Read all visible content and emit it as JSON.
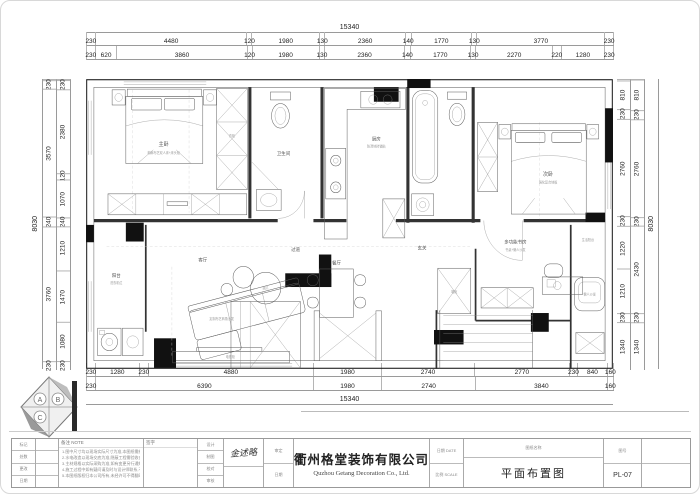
{
  "dims": {
    "top": {
      "total": "15340",
      "row1": [
        230,
        4480,
        120,
        1980,
        130,
        2360,
        140,
        1770,
        130,
        3770,
        230
      ],
      "row2": [
        230,
        620,
        3860,
        120,
        1980,
        130,
        2360,
        140,
        1770,
        130,
        2270,
        220,
        1280,
        230
      ]
    },
    "bottom": {
      "row1": [
        230,
        1280,
        230,
        4880,
        1980,
        2740,
        2770,
        230,
        840,
        160
      ],
      "row2": [
        230,
        6390,
        1980,
        2740,
        3840,
        160
      ],
      "total": "15340"
    },
    "left": {
      "total": "8030",
      "outer": [
        230,
        3570,
        240,
        3760,
        230
      ],
      "inner": [
        230,
        2380,
        120,
        1070,
        240,
        1210,
        1470,
        1080,
        230
      ]
    },
    "right": {
      "inner": [
        810,
        230,
        2760,
        230,
        1220,
        1210,
        230,
        1340
      ],
      "outer": [
        810,
        230,
        2760,
        230,
        2430,
        230,
        1340
      ],
      "total": "8030"
    }
  },
  "rooms": {
    "master": {
      "name": "主卧",
      "note": "棉麻布艺双人床+床头柜",
      "wardrobe": "衣柜"
    },
    "bath1": {
      "name": "卫生间"
    },
    "kitchen": {
      "name": "厨房",
      "note": "防滑地砖铺贴"
    },
    "bed2": {
      "name": "次卧",
      "note": "强化复合地板"
    },
    "hallway": {
      "name": "过道"
    },
    "balcony": {
      "name": "阳台",
      "note": "洗衣机位"
    },
    "living": {
      "name": "客厅",
      "table_note": "圆几",
      "sofa_note": "定制布艺转角沙发",
      "tv_note": "电视柜"
    },
    "dining": {
      "name": "餐厅"
    },
    "entry": {
      "name": "玄关",
      "cabinet_note": "鞋柜"
    },
    "study": {
      "name": "多功能书房",
      "note": "书桌+懒人沙发"
    },
    "balcony2": {
      "name": "生活阳台",
      "chair_note": "懒人沙发"
    }
  },
  "compass": {
    "letters": [
      "A",
      "B",
      "C"
    ]
  },
  "titleblock": {
    "colA": [
      "标记",
      "处数",
      "更改",
      "日期"
    ],
    "colB": [
      "",
      "",
      "",
      ""
    ],
    "notes_header": "备注 NOTE",
    "notes": [
      "1.图中尺寸均以现场实际尺寸为准,本图纸需经公司及业主确认后方可施工。",
      "2.水电改造以现场交底为准,隐蔽工程需验收合格后方可封闭。",
      "3.主材规格以实际采购为准,如有变更另行通知设计师。",
      "4.施工过程中如有疑问请及时与设计师联系,不得擅自更改。",
      "5.本图纸版权归本公司所有,未经许可不得翻印。"
    ],
    "sign_col_header": "签字",
    "colD": [
      "设计",
      "制图",
      "校对",
      "审核"
    ],
    "signature": "金述略",
    "colE": [
      "审定",
      "日期"
    ],
    "company_cn": "衢州格堂装饰有限公司",
    "company_en": "Quzhou Getang Decoration Co., Ltd.",
    "colF": [
      "日期 DATE",
      "比例 SCALE"
    ],
    "name_label": "图纸名称",
    "drawing_title": "平面布置图",
    "no_label": "图号",
    "drawing_no": "PL-07"
  }
}
